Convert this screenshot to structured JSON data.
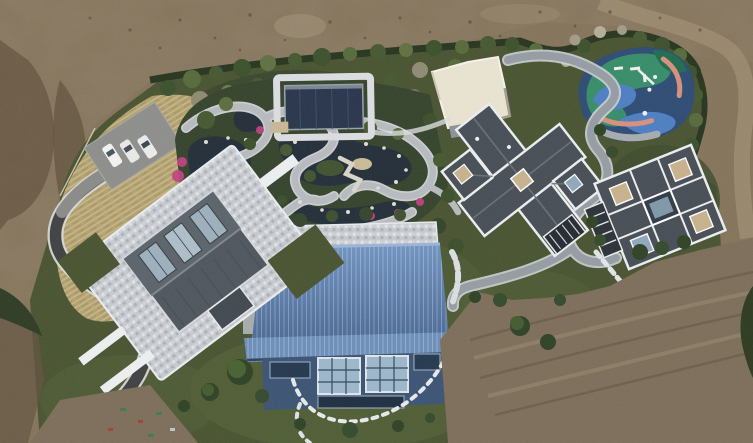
{
  "scene": {
    "type": "aerial-drone-photograph",
    "title": "Top-down aerial view of a landscaped private estate surrounded by bare graded earth"
  },
  "features": {
    "site": "Landscaped estate compound under construction",
    "dirtField": "Bare graded earth with machine tracks",
    "meadow": "Dry ornamental grass meadow",
    "parking": "Parking pad with three white cars",
    "driveway": "Dark asphalt driveway with white edge lines",
    "pondGarden": "Ornamental pond garden with winding stone paths, rocks and magenta azalea beds",
    "pavilion": "Dark flat-roofed garden pavilion with stone surround",
    "courtyardBuilding": "Cream flat-roofed courtyard building",
    "playground": "Colorful playground with blue, teal and coral rubber surface",
    "centralVilla": "Cross-plan villa with dark hip roofs and white parapets",
    "eastVilla": "East villa with rooftop skylights and central lightwell",
    "blueHall": "Large hall with blue standing-seam metal roof and glass south wall",
    "westHall": "West hall with glass gable roof on a mosaic stone plaza",
    "windingPath": "Grey winding garden path",
    "steppingStones": "Stepping-stone paths",
    "hedge": "Clipped dark hedge boundary",
    "lawn": "Mown lawn with specimen shrubs"
  },
  "counts": {
    "cars": 3,
    "villas": 2,
    "halls": 2,
    "ponds": 4
  },
  "palette": {
    "dirt": "#84735a",
    "dirtDark": "#63523d",
    "dirtLight": "#9a8970",
    "dirtRight": "#7c6d58",
    "green": "#47522f",
    "greenDark": "#2e3b20",
    "lawn": "#4f5d34",
    "hedge": "#25331c",
    "shrub1": "#3a4f2a",
    "shrub2": "#55693a",
    "shrub3": "#6d7c49",
    "bareTree": "#a19b85",
    "meadow": "#b3a272",
    "meadowLight": "#cfc08e",
    "pond": "#212c37",
    "stone": "#b7bbbf",
    "stoneLight": "#dcdee1",
    "flower": "#c33f80",
    "asphalt": "#3e3f41",
    "concrete": "#8a8a88",
    "white": "#eef0f1",
    "roofDark": "#454c54",
    "roofRidge": "#6a727a",
    "trim": "#e9ecee",
    "skylight": "#c8b28b",
    "blueRoofA": "#7093c2",
    "blueRoofB": "#496893",
    "blueWall": "#3a5273",
    "glass": "#9db7cc",
    "pavilion": "#27334a",
    "creamRoof": "#eae4d2",
    "pgNavy": "#2c4a73",
    "pgTeal": "#358c68",
    "pgBlue": "#4c7ec2",
    "pgCoral": "#d8907b",
    "pgGray": "#a6abb0",
    "pgGreenDark": "#1e6b4e",
    "path": "#959ca3",
    "pathEdge": "#ced2d5",
    "car": "#f4f4f2"
  }
}
